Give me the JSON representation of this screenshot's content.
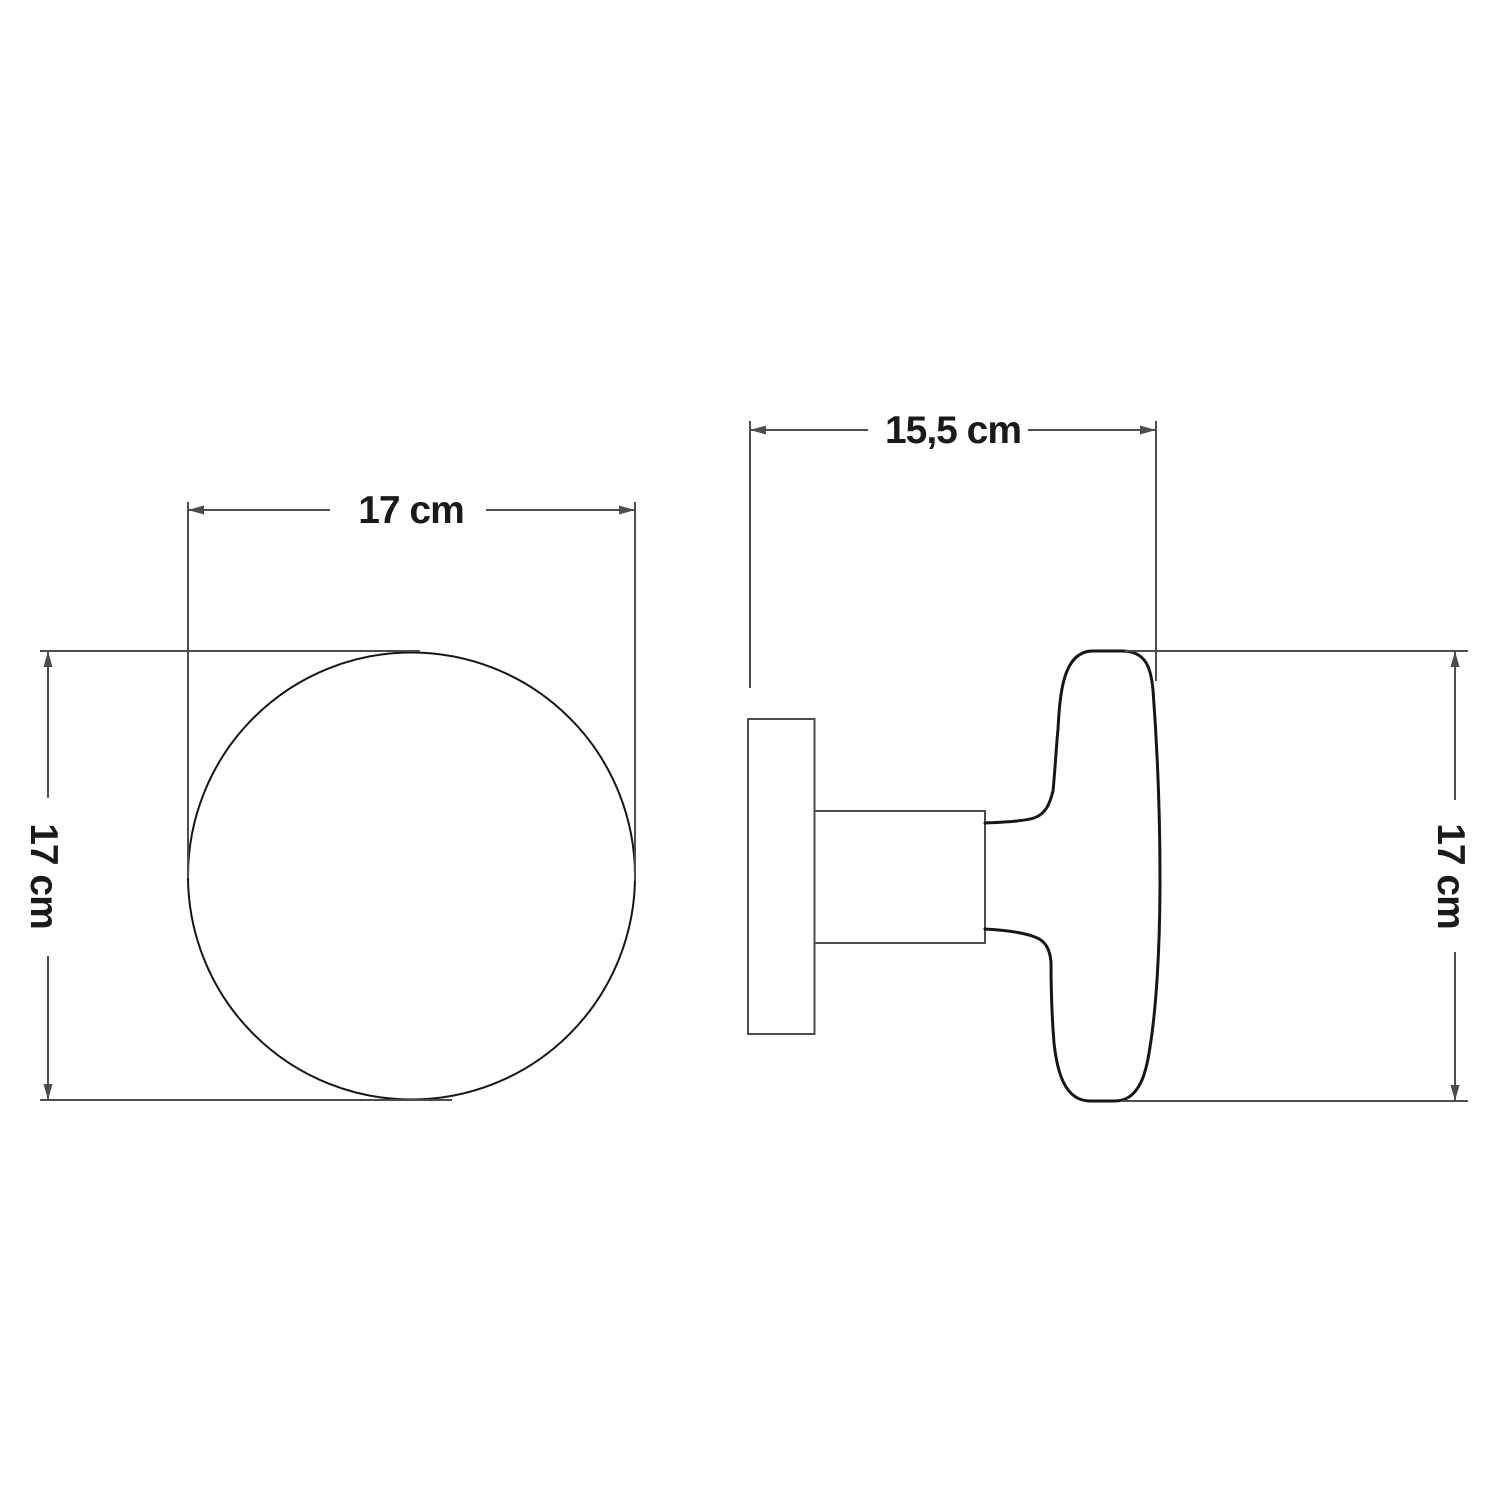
{
  "drawing": {
    "front_view": {
      "width_label": "17 cm",
      "height_label": "17 cm"
    },
    "side_view": {
      "depth_label": "15,5 cm",
      "height_label": "17 cm"
    },
    "colors": {
      "background": "#ffffff",
      "dimension_line": "#4d4d4d",
      "object_outline": "#161616",
      "object_thin_line": "#4d4d4d",
      "text": "#1a1a1a"
    }
  }
}
